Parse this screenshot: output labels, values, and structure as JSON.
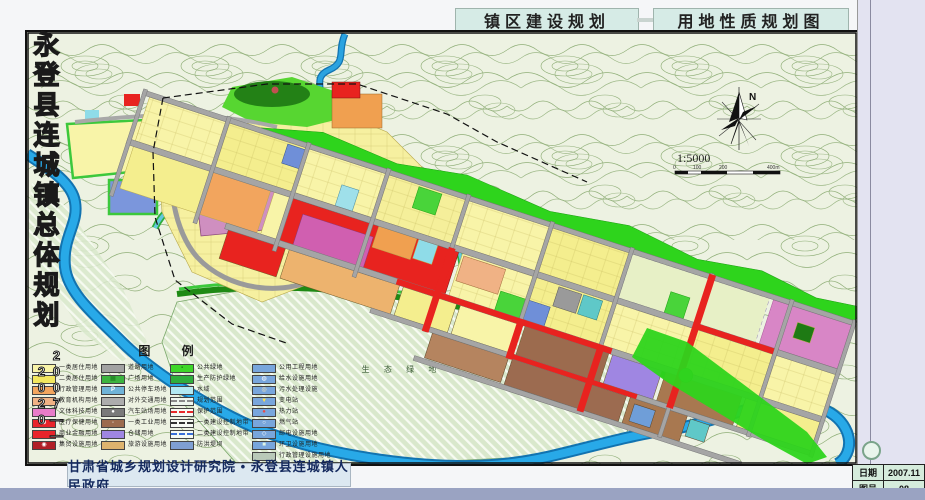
{
  "header": {
    "tabs": [
      {
        "label": "镇区建设规划"
      },
      {
        "label": "用地性质规划图"
      }
    ]
  },
  "sidebar": {
    "title": "永登县连城镇总体规划",
    "years": "2007——2020",
    "info": [
      {
        "label": "日期",
        "value": "2007.11"
      },
      {
        "label": "图号",
        "value": "08"
      }
    ]
  },
  "footer": {
    "credits": "甘肃省城乡规划设计研究院 • 永登县连城镇人民政府"
  },
  "map": {
    "labels": {
      "historic_site": "鲁土司衙门",
      "eco_green": "生 态 绿 地"
    },
    "north_label": "N",
    "scale": {
      "ratio": "1:5000",
      "bar_labels": [
        "0",
        "100",
        "200",
        "400m"
      ]
    }
  },
  "legend": {
    "title": "图  例",
    "columns": [
      {
        "items": [
          {
            "label": "一类居住用地",
            "swatch": {
              "bg": "#f8f4a8"
            }
          },
          {
            "label": "二类居住用地",
            "swatch": {
              "bg": "#f2e75e"
            }
          },
          {
            "label": "行政管理用地",
            "swatch": {
              "bg": "#f2a55e"
            }
          },
          {
            "label": "教育机构用地",
            "swatch": {
              "bg": "#f0b285"
            }
          },
          {
            "label": "文体科技用地",
            "swatch": {
              "bg": "#e87cc8"
            }
          },
          {
            "label": "医疗保健用地",
            "swatch": {
              "bg": "#e8242b",
              "symbol": "⊕",
              "symbolColor": "#ffffff"
            }
          },
          {
            "label": "商业金融用地",
            "swatch": {
              "bg": "#e8242b"
            }
          },
          {
            "label": "集贸设施用地",
            "swatch": {
              "bg": "#b01f26",
              "symbol": "◉",
              "symbolColor": "#ffffff"
            }
          }
        ]
      },
      {
        "items": [
          {
            "label": "道路用地",
            "swatch": {
              "bg": "#a2a2a2"
            }
          },
          {
            "label": "广场用地",
            "swatch": {
              "bg": "#3cb43f",
              "symbol": "▦",
              "symbolColor": "#1c7a1e"
            }
          },
          {
            "label": "公共停车场地",
            "swatch": {
              "bg": "#6fb3d8",
              "symbol": "P",
              "symbolColor": "#ffffff"
            }
          },
          {
            "label": "对外交通用地",
            "swatch": {
              "bg": "#adadad"
            }
          },
          {
            "label": "汽车站场用地",
            "swatch": {
              "bg": "#7a7a7a",
              "symbol": "●",
              "symbolColor": "#ffffff"
            }
          },
          {
            "label": "一类工业用地",
            "swatch": {
              "bg": "#9c6b4e",
              "symbol": "◦",
              "symbolColor": "#ffffff"
            }
          },
          {
            "label": "仓储用地",
            "swatch": {
              "bg": "#9f86e2"
            }
          },
          {
            "label": "旅游设施用地",
            "swatch": {
              "bg": "#ddb36e"
            }
          }
        ]
      },
      {
        "items": [
          {
            "label": "公共绿地",
            "swatch": {
              "bg": "#3ed629",
              "symbol": "▪",
              "symbolColor": "#1d8a12"
            }
          },
          {
            "label": "生产防护绿地",
            "swatch": {
              "bg": "#2fae3c"
            }
          },
          {
            "label": "水域",
            "swatch": {
              "bg": "#b2e9f2"
            }
          },
          {
            "label": "规划范围",
            "swatch": {
              "bg": "#eef6ee",
              "line": "dashed",
              "lineColor": "#8a8a8a"
            }
          },
          {
            "label": "保护范围",
            "swatch": {
              "bg": "none",
              "line": "dashed",
              "lineColor": "#e82a2a"
            }
          },
          {
            "label": "一类建设控制地带",
            "swatch": {
              "bg": "none",
              "line": "dashdot",
              "lineColor": "#333333"
            }
          },
          {
            "label": "二类建设控制地带",
            "swatch": {
              "bg": "none",
              "line": "dashed",
              "lineColor": "#3a6fd8"
            }
          },
          {
            "label": "防洪堤坝",
            "swatch": {
              "bg": "#7f9fd2",
              "hatch": true
            }
          }
        ]
      },
      {
        "items": [
          {
            "label": "公用工程用地",
            "swatch": {
              "bg": "#78a6dc"
            }
          },
          {
            "label": "给水设施用地",
            "swatch": {
              "bg": "#78a6dc",
              "symbol": "◍",
              "symbolColor": "#ffffff"
            }
          },
          {
            "label": "污水处理设施",
            "swatch": {
              "bg": "#78a6dc",
              "symbol": "◎",
              "symbolColor": "#ffe8b0"
            }
          },
          {
            "label": "变电站",
            "swatch": {
              "bg": "#78a6dc",
              "symbol": "▼",
              "symbolColor": "#ffe24a"
            }
          },
          {
            "label": "热力站",
            "swatch": {
              "bg": "#78a6dc",
              "symbol": "●",
              "symbolColor": "#e84a4a"
            }
          },
          {
            "label": "燃气站",
            "swatch": {
              "bg": "#78a6dc",
              "symbol": "○",
              "symbolColor": "#ffffff"
            }
          },
          {
            "label": "邮电设施用地",
            "swatch": {
              "bg": "#78a6dc",
              "symbol": "◇",
              "symbolColor": "#ffffff"
            }
          },
          {
            "label": "环卫设施用地",
            "swatch": {
              "bg": "#78a6dc",
              "symbol": "■",
              "symbolColor": "#dff5e4"
            }
          },
          {
            "label": "行政管理设施用地",
            "swatch": {
              "bg": "#b9c9b9",
              "hatch": true
            }
          }
        ]
      }
    ]
  }
}
